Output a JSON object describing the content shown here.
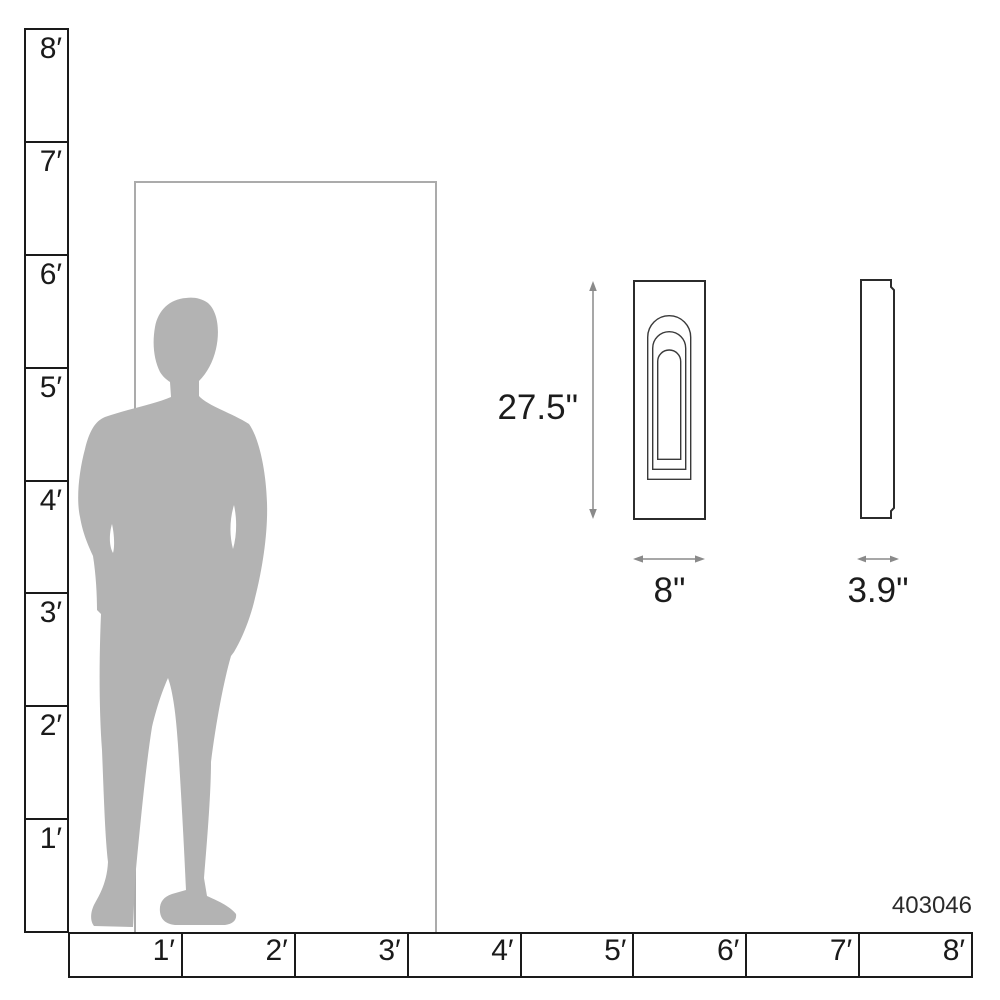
{
  "diagram": {
    "sku": "403046",
    "dimensions": {
      "height": "27.5\"",
      "width": "8\"",
      "depth": "3.9\""
    },
    "rulers": {
      "vertical": [
        "8′",
        "7′",
        "6′",
        "5′",
        "4′",
        "3′",
        "2′",
        "1′"
      ],
      "horizontal": [
        "1′",
        "2′",
        "3′",
        "4′",
        "5′",
        "6′",
        "7′",
        "8′"
      ]
    },
    "colors": {
      "ruler_line": "#1a1a1a",
      "door_outline": "#ababab",
      "silhouette": "#b3b3b3",
      "product_outline": "#2b2b2b",
      "product_detail_line": "#3a3a3a",
      "dimension_line": "#8a8a8a",
      "text": "#1c1c1c"
    }
  }
}
